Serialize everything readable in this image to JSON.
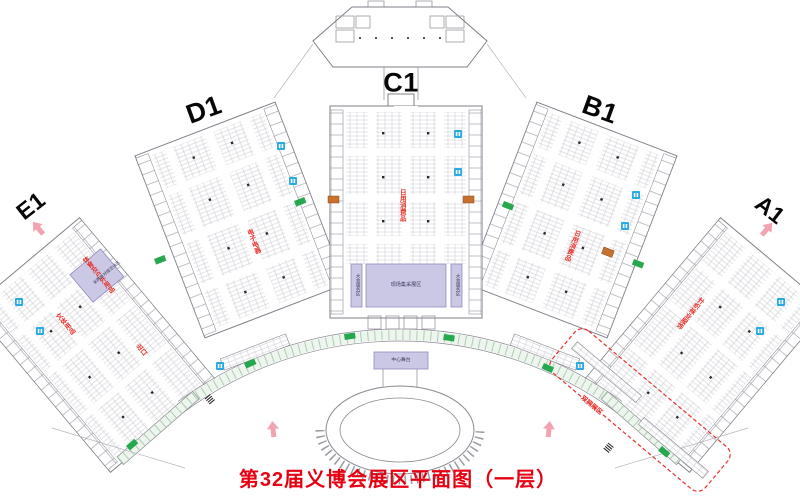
{
  "title": "第32届义博会展区平面图（一层）",
  "halls": {
    "c1": {
      "name": "C1",
      "zone": "日用消费品"
    },
    "d1": {
      "name": "D1",
      "zone": "电子电器"
    },
    "b1": {
      "name": "B1",
      "zone": "日用消费品"
    },
    "e1": {
      "name": "E1",
      "zone_primary": "体育及户外用品",
      "zone_secondary": "文体用品",
      "gate": "出口",
      "lounge": "采购商对接洽谈区"
    },
    "a1": {
      "name": "A1",
      "zone": "针织袜业服饰"
    }
  },
  "facilities": {
    "procurement_zone": "现场集采展区",
    "service_left": "大会服务区",
    "service_right": "大会服务区",
    "stage": "中心舞台",
    "outdoor_zone": "双拥展区"
  },
  "icons": {
    "restroom": "two-figure blue square",
    "exit": "green block",
    "service_gate": "orange block",
    "entrance_arrow": "pink up arrow",
    "stairs": "hatched steps"
  },
  "colors": {
    "title_red": "#e60012",
    "zone_red": "#e8312a",
    "restroom_blue": "#29abe2",
    "exit_green": "#27a84e",
    "gate_orange": "#c8702e",
    "arrow_pink": "#f2a3b1",
    "highlight_purple": "#cbc8e6",
    "wall_gray": "#7f7f8a"
  }
}
